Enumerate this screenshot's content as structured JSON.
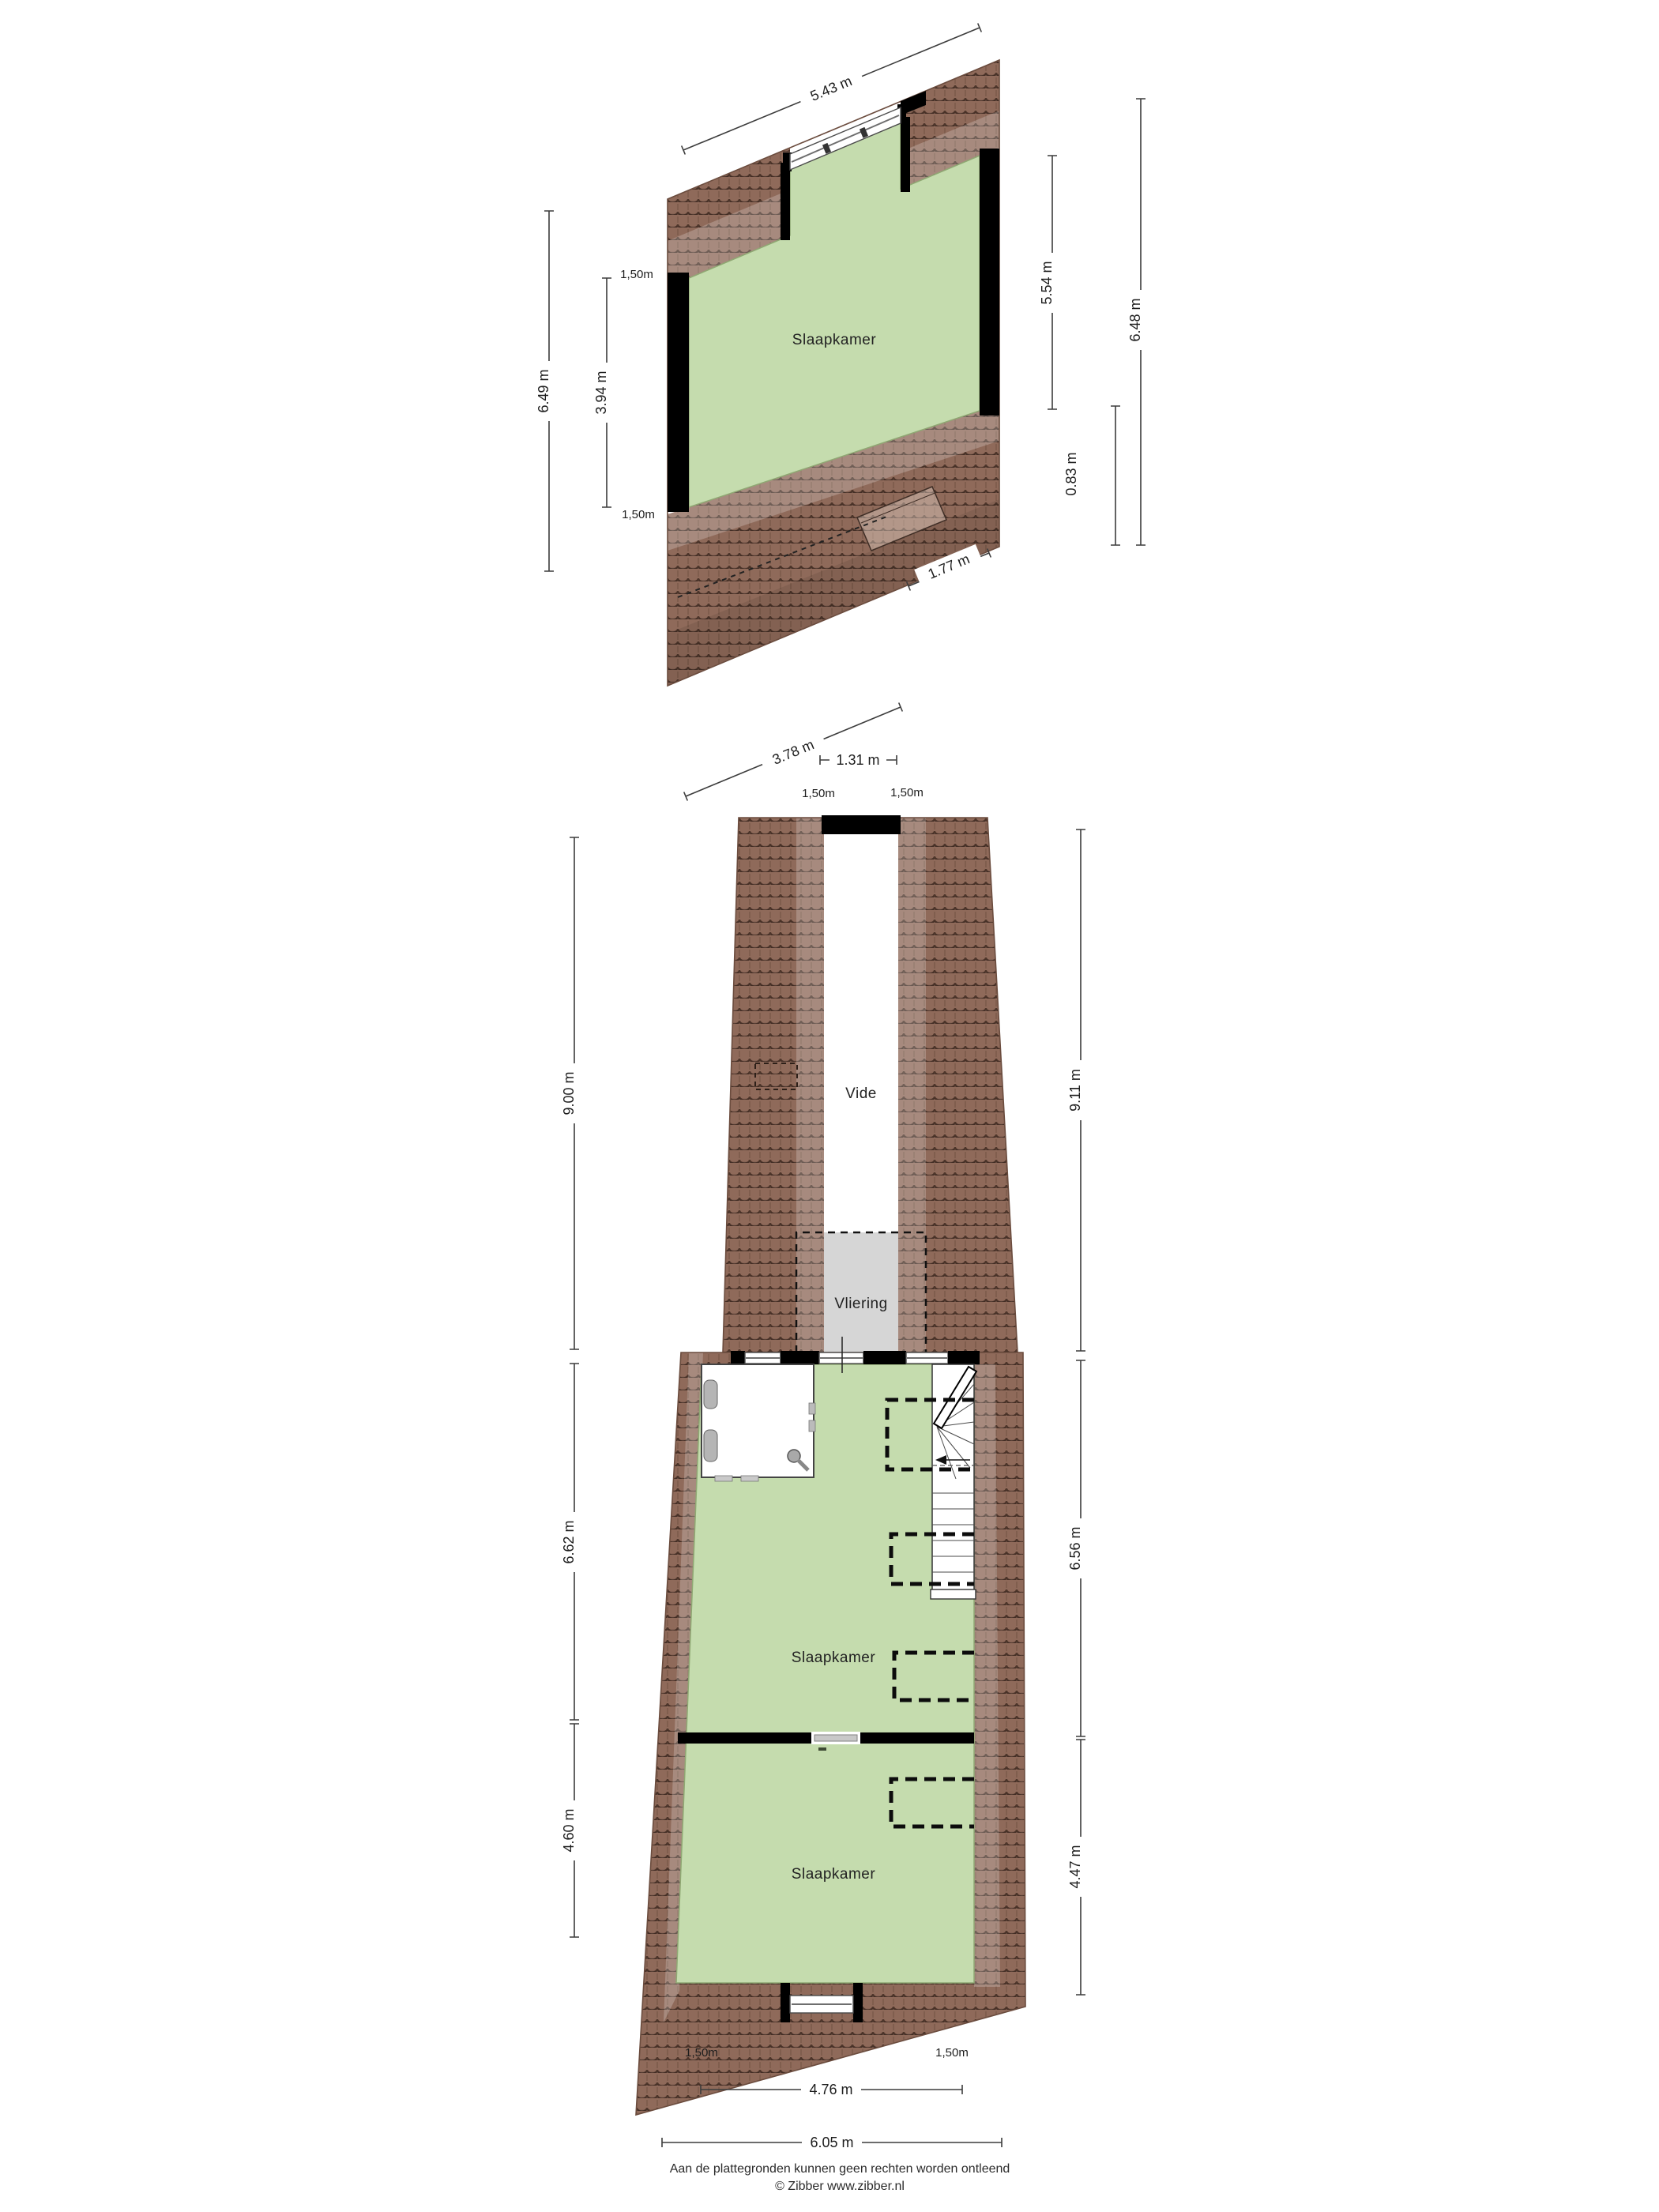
{
  "floor2": {
    "room": "Slaapkamer",
    "dims": {
      "top": "5.43 m",
      "left_outer": "6.49 m",
      "left_inner": "3.94 m",
      "knee_top": "1,50m",
      "knee_bottom": "1,50m",
      "right_inner": "5.54 m",
      "right_band": "0.83 m",
      "right_outer": "6.48 m",
      "bottom_main": "3.78 m",
      "bottom_right": "1.77 m"
    }
  },
  "floor3": {
    "vide": "Vide",
    "vliering": "Vliering",
    "room_middle": "Slaapkamer",
    "room_bottom": "Slaapkamer",
    "dims": {
      "top": "1.31 m",
      "knee_top_left": "1,50m",
      "knee_top_right": "1,50m",
      "left_upper": "9.00 m",
      "right_upper": "9.11 m",
      "left_middle": "6.62 m",
      "right_middle": "6.56 m",
      "left_lower": "4.60 m",
      "right_lower": "4.47 m",
      "knee_bottom_left": "1,50m",
      "knee_bottom_right": "1,50m",
      "bottom_inner": "4.76 m",
      "bottom_outer": "6.05 m"
    }
  },
  "footer": {
    "disclaimer": "Aan de plattegronden kunnen geen rechten worden ontleend",
    "copyright": "© Zibber www.zibber.nl"
  },
  "colors": {
    "room_fill": "#c5dcae",
    "roof_base": "#8f6a5a",
    "roof_line": "#4e362b",
    "vliering_fill": "#d6d6d6",
    "wall": "#000000",
    "dim_line": "#3c3c3c"
  }
}
